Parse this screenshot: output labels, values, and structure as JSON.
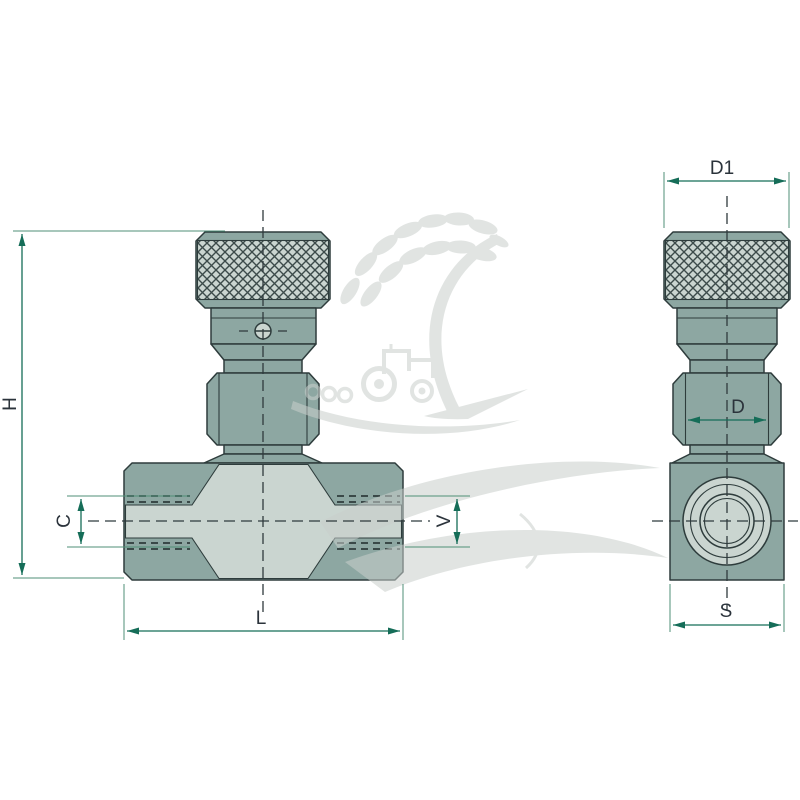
{
  "page": {
    "background_color": "#ffffff",
    "content_type": "two-view technical dimension drawing of a hydraulic throttle (needle) valve with knurled adjustment knob"
  },
  "drawing": {
    "front_view": {
      "name": "front-view",
      "parts": [
        "knurled-knob",
        "lock-collar-with-slotted-screw",
        "hex-stem-section",
        "t-shaped-body-with-threaded-ports"
      ]
    },
    "side_view": {
      "name": "side-view",
      "parts": [
        "knurled-knob",
        "hex-stem-section",
        "square-body-with-circular-threaded-port"
      ]
    },
    "dimensions": {
      "front": [
        {
          "label": "H",
          "orientation": "vertical"
        },
        {
          "label": "C",
          "orientation": "vertical"
        },
        {
          "label": "L",
          "orientation": "horizontal"
        },
        {
          "label": "V",
          "orientation": "vertical"
        }
      ],
      "side": [
        {
          "label": "D1",
          "orientation": "horizontal"
        },
        {
          "label": "D",
          "orientation": "horizontal"
        },
        {
          "label": "S",
          "orientation": "horizontal"
        }
      ]
    },
    "watermark": {
      "description": "agricultural-parts logo watermark: wheat-ear leaf arc, tractor silhouette with tilled ground, large sweeping leaves"
    },
    "colors": {
      "background": "#ffffff",
      "body_dark": "#8da7a2",
      "body_light": "#cad5d0",
      "outline": "#2e3c3c",
      "centerline": "#2f3a3d",
      "dimension_line": "#156d58",
      "extension_line": "#4f8f77",
      "label_text": "#2b333b",
      "watermark_gray": "#c9cfcc"
    }
  }
}
